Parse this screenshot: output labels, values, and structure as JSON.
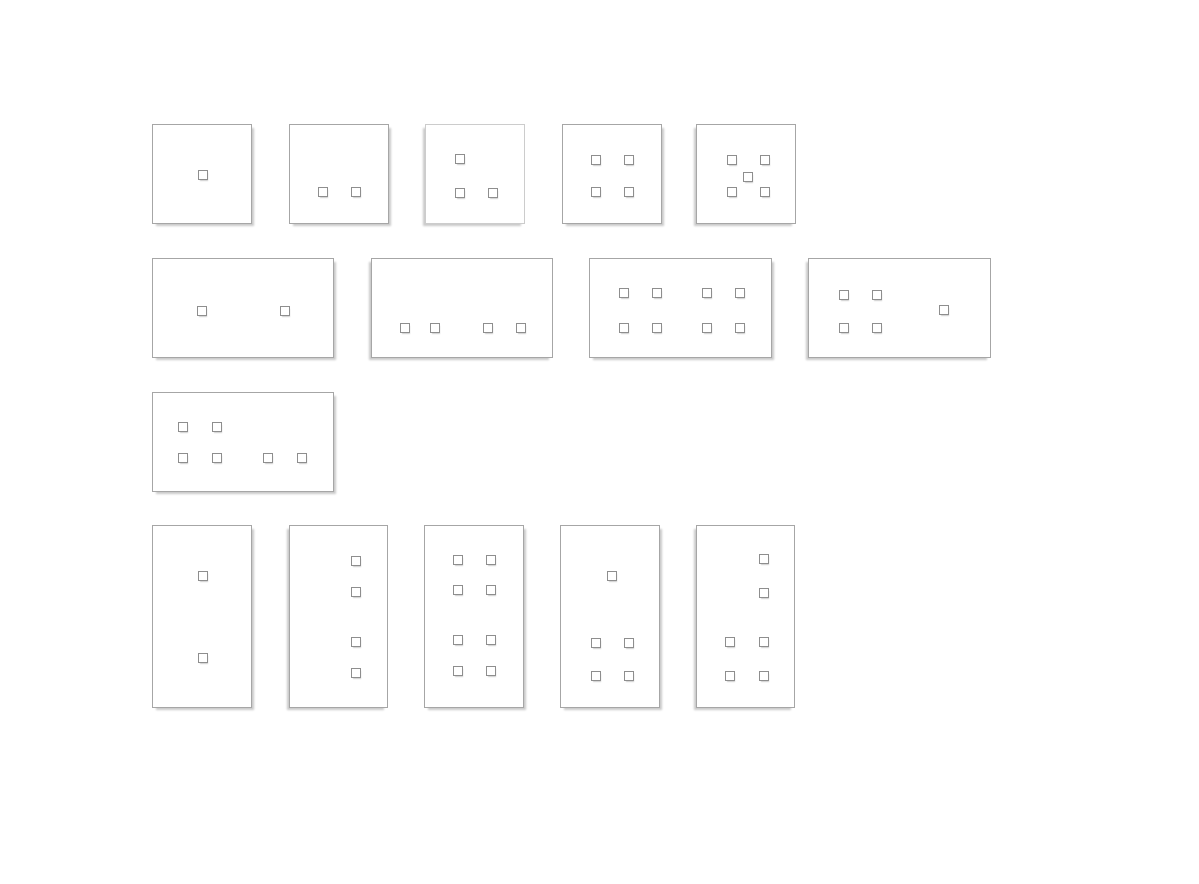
{
  "canvas": {
    "width": 1199,
    "height": 884,
    "background": "#ffffff"
  },
  "styles": {
    "panel_fill": "#ffffff",
    "panel_border": "#a6a6a6",
    "panel_border_light": "#cccccc",
    "panel_shadow": "#c9c9c9",
    "button_fill": "#ffffff",
    "button_border": "#8e8e8e",
    "button_shadow": "#cccccc",
    "button_size": 10
  },
  "panels": [
    {
      "name": "plate-square-1-button",
      "shape": "square",
      "button_count": 1,
      "x": 152,
      "y": 124,
      "w": 100,
      "h": 100,
      "shadow": "right",
      "border": "normal",
      "buttons": [
        [
          50,
          50
        ]
      ]
    },
    {
      "name": "plate-square-2-buttons",
      "shape": "square",
      "button_count": 2,
      "x": 289,
      "y": 124,
      "w": 100,
      "h": 100,
      "shadow": "right",
      "border": "normal",
      "buttons": [
        [
          33,
          67
        ],
        [
          66,
          67
        ]
      ]
    },
    {
      "name": "plate-square-3-buttons",
      "shape": "square",
      "button_count": 3,
      "x": 425,
      "y": 124,
      "w": 100,
      "h": 100,
      "shadow": "left",
      "border": "light",
      "buttons": [
        [
          34,
          34
        ],
        [
          34,
          68
        ],
        [
          67,
          68
        ]
      ]
    },
    {
      "name": "plate-square-4-buttons",
      "shape": "square",
      "button_count": 4,
      "x": 562,
      "y": 124,
      "w": 100,
      "h": 100,
      "shadow": "right",
      "border": "normal",
      "buttons": [
        [
          33,
          35
        ],
        [
          66,
          35
        ],
        [
          33,
          67
        ],
        [
          66,
          67
        ]
      ]
    },
    {
      "name": "plate-square-5-buttons",
      "shape": "square",
      "button_count": 5,
      "x": 696,
      "y": 124,
      "w": 100,
      "h": 100,
      "shadow": "left",
      "border": "normal",
      "buttons": [
        [
          35,
          35
        ],
        [
          68,
          35
        ],
        [
          51,
          52
        ],
        [
          35,
          67
        ],
        [
          68,
          67
        ]
      ]
    },
    {
      "name": "plate-wide-2-buttons",
      "shape": "wide",
      "button_count": 2,
      "x": 152,
      "y": 258,
      "w": 182,
      "h": 100,
      "shadow": "right",
      "border": "normal",
      "buttons": [
        [
          49,
          52
        ],
        [
          132,
          52
        ]
      ]
    },
    {
      "name": "plate-wide-4-buttons",
      "shape": "wide",
      "button_count": 4,
      "x": 371,
      "y": 258,
      "w": 182,
      "h": 100,
      "shadow": "left",
      "border": "normal",
      "buttons": [
        [
          33,
          69
        ],
        [
          63,
          69
        ],
        [
          116,
          69
        ],
        [
          149,
          69
        ]
      ]
    },
    {
      "name": "plate-wide-8-buttons",
      "shape": "wide",
      "button_count": 8,
      "x": 589,
      "y": 258,
      "w": 183,
      "h": 100,
      "shadow": "right",
      "border": "normal",
      "buttons": [
        [
          34,
          34
        ],
        [
          67,
          34
        ],
        [
          117,
          34
        ],
        [
          150,
          34
        ],
        [
          34,
          69
        ],
        [
          67,
          69
        ],
        [
          117,
          69
        ],
        [
          150,
          69
        ]
      ]
    },
    {
      "name": "plate-wide-5-buttons",
      "shape": "wide",
      "button_count": 5,
      "x": 808,
      "y": 258,
      "w": 183,
      "h": 100,
      "shadow": "left",
      "border": "normal",
      "buttons": [
        [
          35,
          36
        ],
        [
          68,
          36
        ],
        [
          35,
          69
        ],
        [
          68,
          69
        ],
        [
          135,
          51
        ]
      ]
    },
    {
      "name": "plate-wide-6-buttons",
      "shape": "wide",
      "button_count": 6,
      "x": 152,
      "y": 392,
      "w": 182,
      "h": 100,
      "shadow": "right",
      "border": "normal",
      "buttons": [
        [
          30,
          34
        ],
        [
          64,
          34
        ],
        [
          30,
          65
        ],
        [
          64,
          65
        ],
        [
          115,
          65
        ],
        [
          149,
          65
        ]
      ]
    },
    {
      "name": "plate-tall-2-buttons",
      "shape": "tall",
      "button_count": 2,
      "x": 152,
      "y": 525,
      "w": 100,
      "h": 183,
      "shadow": "right",
      "border": "normal",
      "buttons": [
        [
          50,
          50
        ],
        [
          50,
          132
        ]
      ]
    },
    {
      "name": "plate-tall-4-buttons",
      "shape": "tall",
      "button_count": 4,
      "x": 289,
      "y": 525,
      "w": 99,
      "h": 183,
      "shadow": "left",
      "border": "normal",
      "buttons": [
        [
          66,
          35
        ],
        [
          66,
          66
        ],
        [
          66,
          116
        ],
        [
          66,
          147
        ]
      ]
    },
    {
      "name": "plate-tall-8-buttons",
      "shape": "tall",
      "button_count": 8,
      "x": 424,
      "y": 525,
      "w": 100,
      "h": 183,
      "shadow": "right",
      "border": "normal",
      "buttons": [
        [
          33,
          34
        ],
        [
          66,
          34
        ],
        [
          33,
          64
        ],
        [
          66,
          64
        ],
        [
          33,
          114
        ],
        [
          66,
          114
        ],
        [
          33,
          145
        ],
        [
          66,
          145
        ]
      ]
    },
    {
      "name": "plate-tall-5-buttons",
      "shape": "tall",
      "button_count": 5,
      "x": 560,
      "y": 525,
      "w": 100,
      "h": 183,
      "shadow": "right",
      "border": "normal",
      "buttons": [
        [
          51,
          50
        ],
        [
          35,
          117
        ],
        [
          68,
          117
        ],
        [
          35,
          150
        ],
        [
          68,
          150
        ]
      ]
    },
    {
      "name": "plate-tall-6-buttons",
      "shape": "tall",
      "button_count": 6,
      "x": 696,
      "y": 525,
      "w": 99,
      "h": 183,
      "shadow": "left",
      "border": "normal",
      "buttons": [
        [
          67,
          33
        ],
        [
          67,
          67
        ],
        [
          33,
          116
        ],
        [
          67,
          116
        ],
        [
          33,
          150
        ],
        [
          67,
          150
        ]
      ]
    }
  ]
}
